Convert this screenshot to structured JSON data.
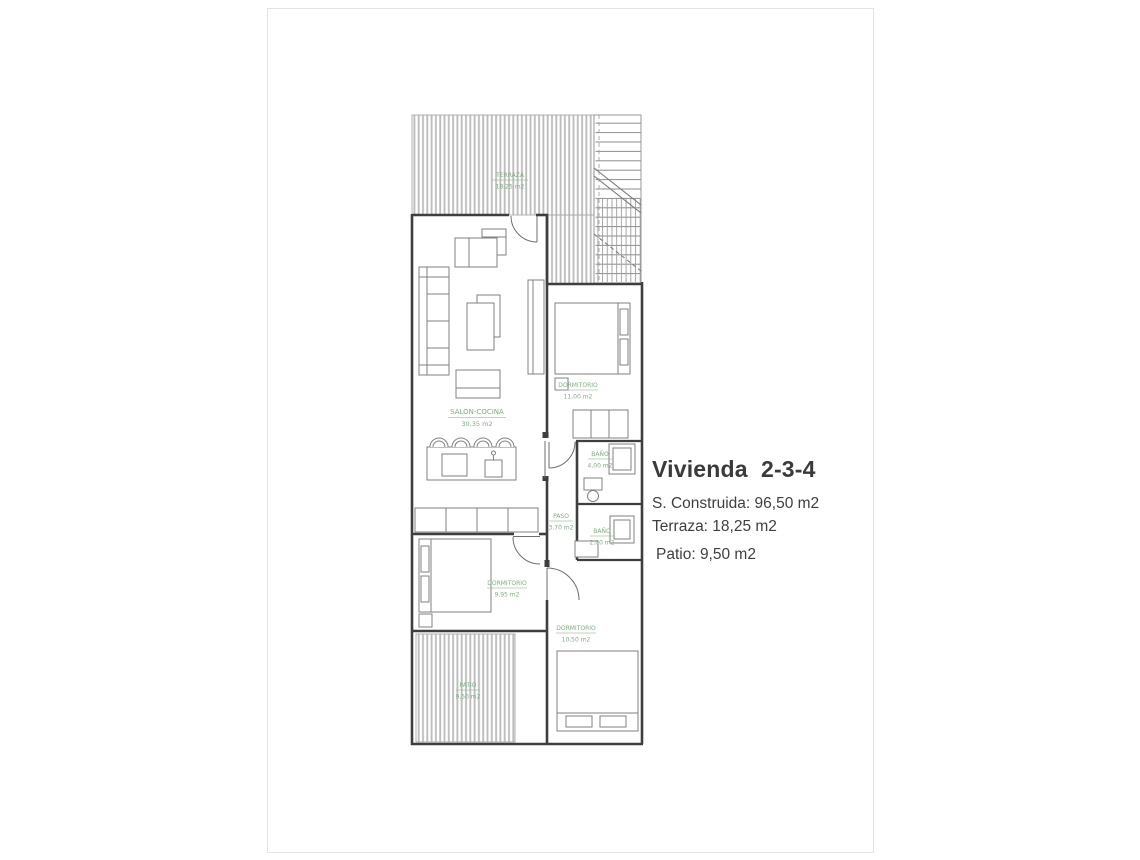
{
  "info": {
    "title": "Vivienda  2-3-4",
    "lines": [
      "S. Construida: 96,50 m2",
      "Terraza: 18,25 m2",
      "Patio: 9,50 m2"
    ]
  },
  "plan": {
    "rooms": {
      "terraza": {
        "name": "TERRAZA",
        "area": "18,25 m2"
      },
      "salon_cocina": {
        "name": "SALON-COCINA",
        "area": "30,35 m2"
      },
      "dormitorio_1": {
        "name": "DORMITORIO",
        "area": "11,00 m2"
      },
      "bano_1": {
        "name": "BAÑO",
        "area": "4,00 m2"
      },
      "paso": {
        "name": "PASO",
        "area": "3,70 m2"
      },
      "bano_2": {
        "name": "BAÑO",
        "area": "2,00 m2"
      },
      "dormitorio_2": {
        "name": "DORMITORIO",
        "area": "9,95 m2"
      },
      "dormitorio_3": {
        "name": "DORMITORIO",
        "area": "10,50 m2"
      },
      "patio": {
        "name": "PATIO",
        "area": "9,50 m2"
      }
    },
    "colors": {
      "label_green": "#7fae7f",
      "wall": "#3e3e3e",
      "hatch": "#bdbdbd",
      "furniture_line": "#828282",
      "body_text": "#3f3f3f"
    }
  }
}
